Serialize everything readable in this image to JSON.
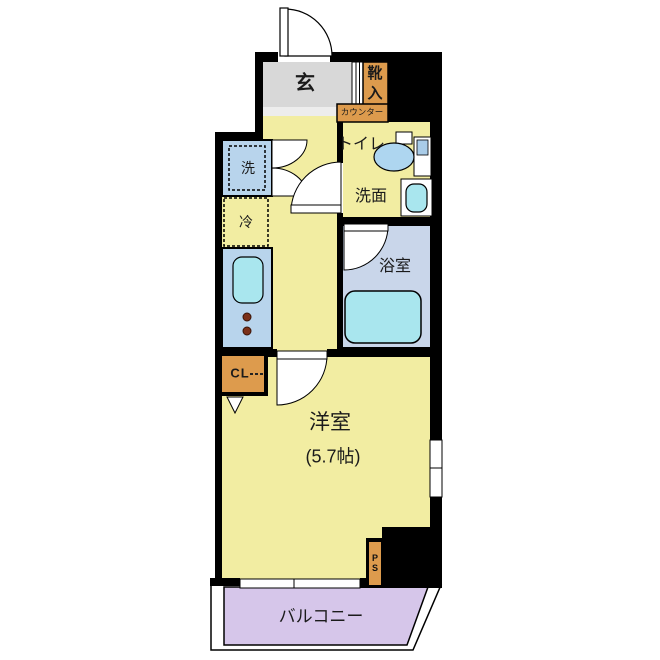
{
  "floorplan": {
    "labels": {
      "genkan": "玄",
      "shoe_box": "靴\n入",
      "counter": "カウンター",
      "toilet": "トイレ",
      "washroom": "洗面",
      "bathroom": "浴室",
      "washer": "洗",
      "fridge": "冷",
      "closet": "CL",
      "main_room": "洋室",
      "main_room_size": "(5.7帖)",
      "pipe_space": "P\nS",
      "balcony": "バルコニー"
    },
    "colors": {
      "floor": "#f2eda2",
      "entrance_gray": "#d8d8d8",
      "step_edge": "#ededed",
      "cabinet_orange": "#dd9b4d",
      "counter_blue": "#b8d4ec",
      "water_cyan": "#a9e6ee",
      "toilet_blue": "#aed6f0",
      "tank_inner": "#a9cce8",
      "bath_floor_blue": "#c9d6ea",
      "balcony_purple": "#d6c6ea",
      "burner_brown": "#7b3018",
      "wall": "#000000"
    }
  }
}
